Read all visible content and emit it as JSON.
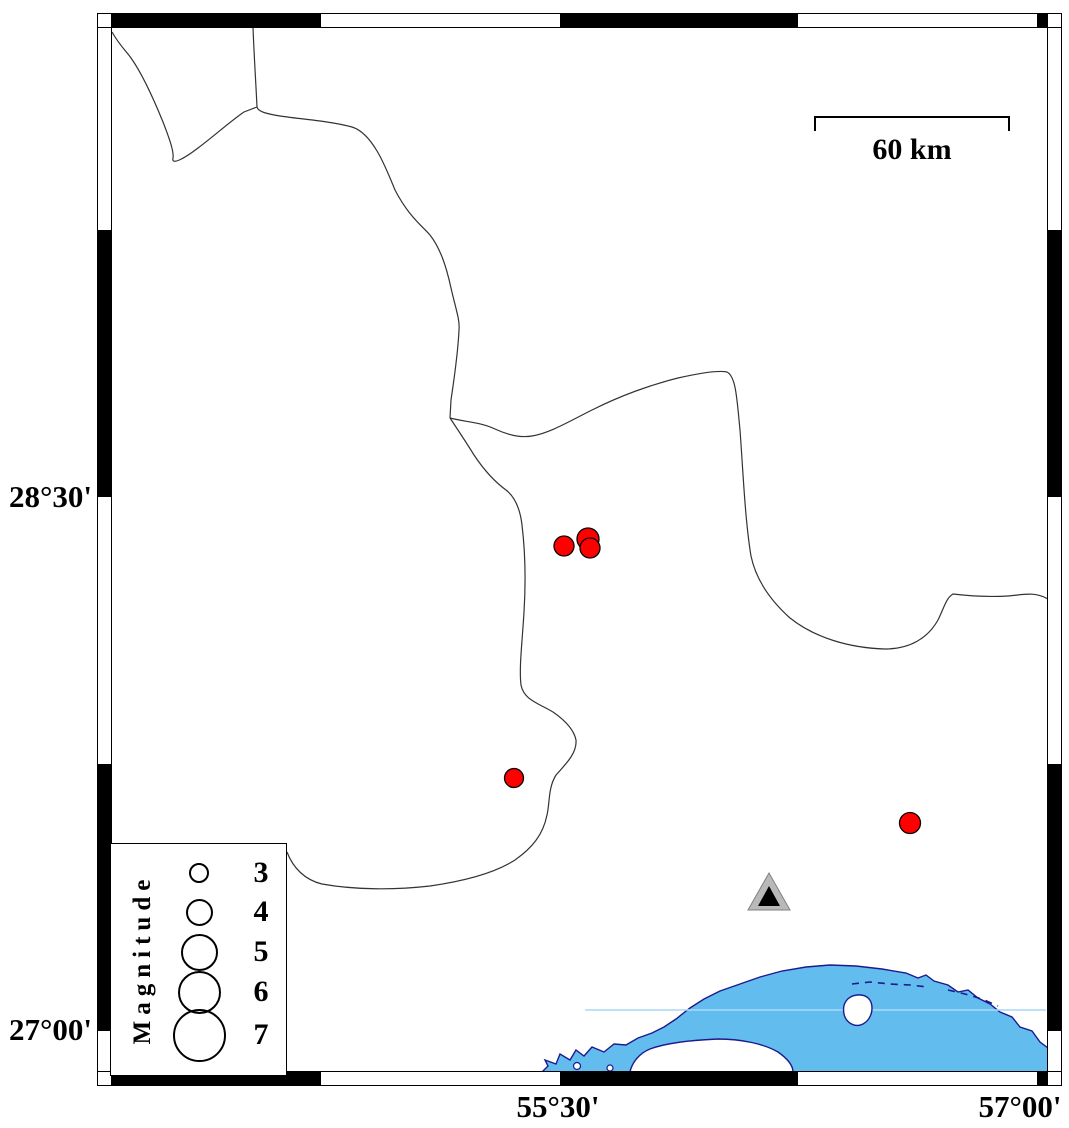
{
  "map": {
    "labels": {
      "lat_top": "28°30'",
      "lat_bottom": "27°00'",
      "lon_left": "55°30'",
      "lon_right": "57°00'"
    },
    "scale_bar": {
      "label": "60 km"
    },
    "colors": {
      "event_fill": "#FF0000",
      "water_fill": "#63BCEE",
      "coast_stroke": "#1b1b8f",
      "boundary_stroke": "#333333",
      "station_outer": "#b9b9b9",
      "station_inner": "#000000",
      "frame": "#000000"
    },
    "events": [
      {
        "x": 564,
        "y": 546,
        "r": 10
      },
      {
        "x": 588,
        "y": 539,
        "r": 11
      },
      {
        "x": 590,
        "y": 548,
        "r": 10
      },
      {
        "x": 514,
        "y": 778,
        "r": 9.5
      },
      {
        "x": 910,
        "y": 823,
        "r": 10.5
      }
    ],
    "station": {
      "x": 769,
      "y": 897
    }
  },
  "legend": {
    "title": "Magnitude",
    "items": [
      {
        "label": "3",
        "diameter_px": 20
      },
      {
        "label": "4",
        "diameter_px": 27
      },
      {
        "label": "5",
        "diameter_px": 37
      },
      {
        "label": "6",
        "diameter_px": 43
      },
      {
        "label": "7",
        "diameter_px": 53
      }
    ]
  }
}
